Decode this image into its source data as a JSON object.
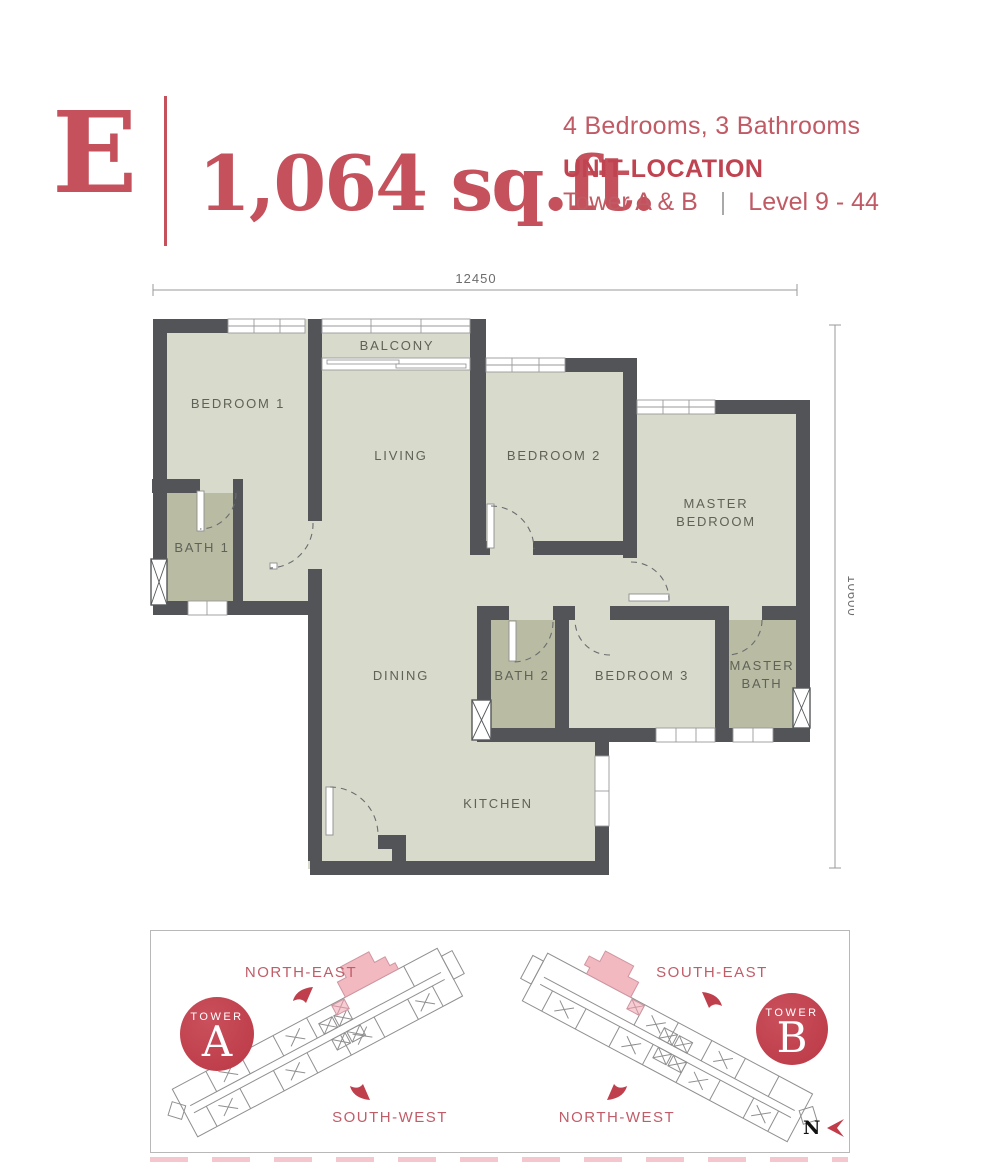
{
  "header": {
    "unit_type": "E",
    "area": "1,064 sq.ft.",
    "bed_bath": "4 Bedrooms, 3 Bathrooms",
    "unit_location_label": "UNIT LOCATION",
    "towers": "Tower A & B",
    "separator": "|",
    "levels": "Level 9 - 44"
  },
  "floor_plan": {
    "dim_width": "12450",
    "dim_height": "10600",
    "rooms": [
      {
        "id": "bedroom-1",
        "label": "BEDROOM 1"
      },
      {
        "id": "balcony",
        "label": "BALCONY"
      },
      {
        "id": "living",
        "label": "LIVING"
      },
      {
        "id": "bedroom-2",
        "label": "BEDROOM 2"
      },
      {
        "id": "master-bedroom",
        "label_line1": "MASTER",
        "label_line2": "BEDROOM"
      },
      {
        "id": "bath-1",
        "label": "BATH 1"
      },
      {
        "id": "dining",
        "label": "DINING"
      },
      {
        "id": "bath-2",
        "label": "BATH 2"
      },
      {
        "id": "bedroom-3",
        "label": "BEDROOM 3"
      },
      {
        "id": "master-bath",
        "label_line1": "MASTER",
        "label_line2": "BATH"
      },
      {
        "id": "kitchen",
        "label": "KITCHEN"
      }
    ]
  },
  "site_plans": {
    "tower_a": {
      "badge_word": "TOWER",
      "badge_letter": "A",
      "dir_top": "NORTH-EAST",
      "dir_bottom": "SOUTH-WEST"
    },
    "tower_b": {
      "badge_word": "TOWER",
      "badge_letter": "B",
      "dir_top": "SOUTH-EAST",
      "dir_bottom": "NORTH-WEST"
    },
    "compass_label": "N"
  },
  "colors": {
    "accent_red": "#c4515c",
    "badge_red": "#bf3e4b",
    "wall_dark": "#525457",
    "room_fill": "#d8dacb",
    "bath_fill": "#b9bca3",
    "highlight_pink": "#f2b9c1"
  }
}
